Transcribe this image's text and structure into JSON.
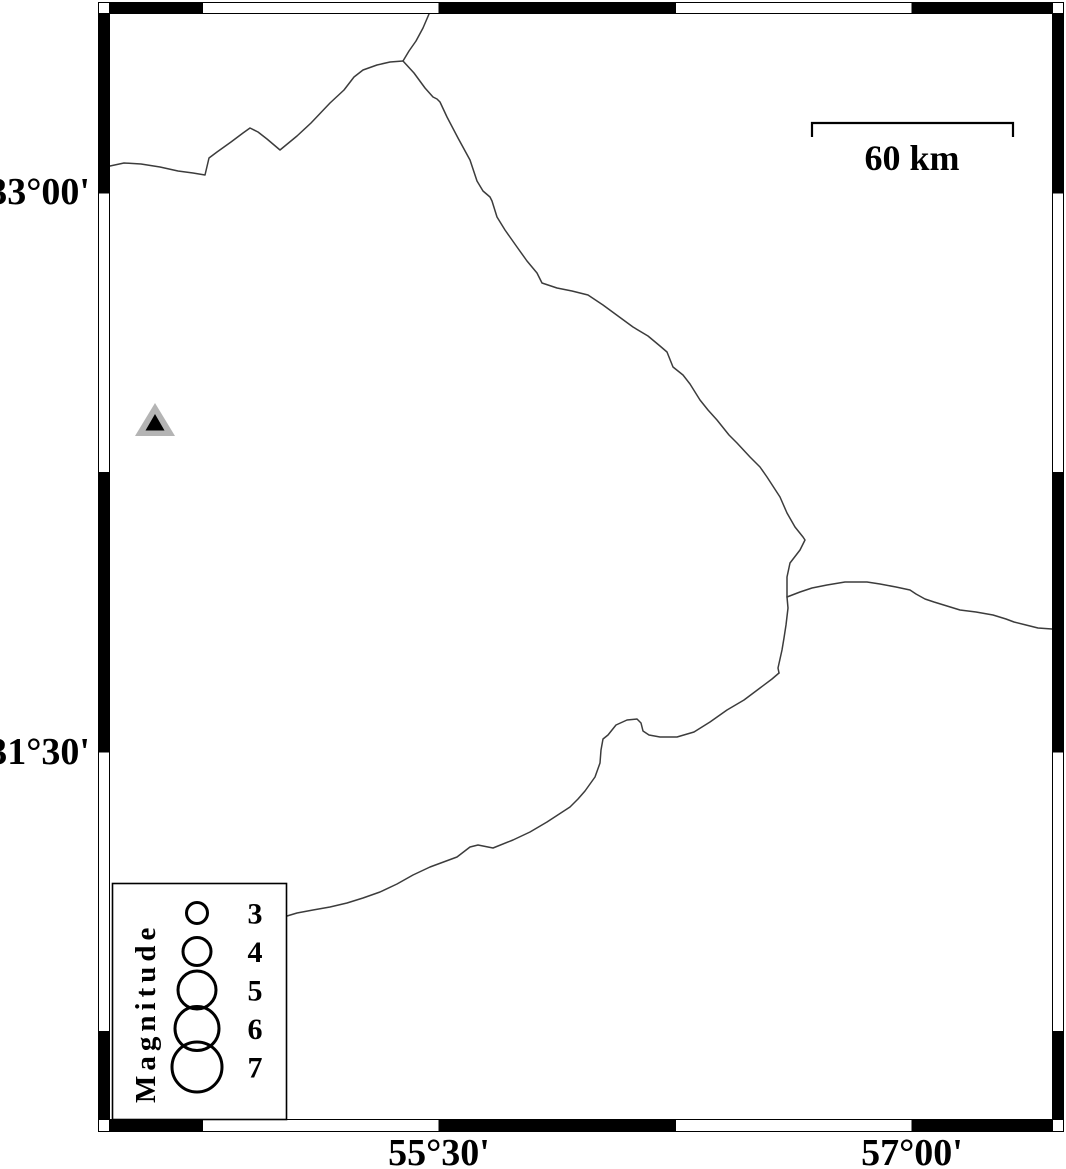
{
  "figure": {
    "type": "seismicity-map",
    "background": "#ffffff",
    "frame_color": "#000000",
    "road_color": "#3c3c3c",
    "width": 1066,
    "height": 1169
  },
  "frame": {
    "outer": {
      "x1": 98.5,
      "y1": 2.5,
      "x2": 1063.5,
      "y2": 1131.5
    },
    "inner": {
      "x1": 109.5,
      "y1": 13.5,
      "x2": 1052.5,
      "y2": 1119.5
    },
    "x_bounds": [
      110,
      202.5,
      439,
      675.5,
      912,
      1052.5
    ],
    "y_bounds": [
      13.5,
      193,
      472.5,
      752,
      1031.5,
      1119.5
    ]
  },
  "axes": {
    "lat_ticks": [
      {
        "label": "33°00'",
        "y": 192
      },
      {
        "label": "31°30'",
        "y": 752
      }
    ],
    "lon_ticks": [
      {
        "label": "55°30'",
        "x": 439
      },
      {
        "label": "57°00'",
        "x": 912
      }
    ]
  },
  "scale_bar": {
    "label": "60 km",
    "x1": 812,
    "x2": 1013,
    "y": 123,
    "tick_len": 14,
    "label_x": 912,
    "label_y": 170
  },
  "station_marker": {
    "shape": "triangle",
    "outer_points": "135,436 175,436 155,403",
    "inner_points": "145.5,430.5 164.5,430.5 155,414",
    "outer_color": "#b4b4b4",
    "inner_color": "#000000"
  },
  "legend": {
    "title": "Magnitude",
    "box": {
      "x": 112.5,
      "y": 883.5,
      "w": 174,
      "h": 236
    },
    "circle_x": 197,
    "number_x": 255,
    "title_x": 155,
    "title_y": 1103,
    "items": [
      {
        "magnitude": "3",
        "radius": 10.5,
        "row_y": 913
      },
      {
        "magnitude": "4",
        "radius": 14,
        "row_y": 951.5
      },
      {
        "magnitude": "5",
        "radius": 19,
        "row_y": 990
      },
      {
        "magnitude": "6",
        "radius": 22,
        "row_y": 1028.5
      },
      {
        "magnitude": "7",
        "radius": 25,
        "row_y": 1067
      }
    ]
  },
  "roads": [
    {
      "name": "west-road",
      "points": [
        [
          110,
          166
        ],
        [
          124,
          163
        ],
        [
          141,
          164
        ],
        [
          160,
          167
        ],
        [
          178,
          171
        ],
        [
          193,
          173
        ],
        [
          205,
          175
        ],
        [
          209,
          158
        ],
        [
          217,
          152
        ],
        [
          231,
          142
        ],
        [
          243,
          133
        ],
        [
          250,
          128
        ],
        [
          258,
          132
        ],
        [
          267,
          139
        ],
        [
          280,
          150
        ],
        [
          297,
          136
        ],
        [
          311,
          123
        ],
        [
          330,
          103
        ],
        [
          344,
          90
        ],
        [
          354,
          77
        ],
        [
          363,
          70
        ],
        [
          377,
          65
        ],
        [
          390,
          62
        ],
        [
          403,
          61
        ]
      ]
    },
    {
      "name": "north-branch",
      "points": [
        [
          403,
          61
        ],
        [
          409,
          51
        ],
        [
          416,
          41
        ],
        [
          423,
          28
        ],
        [
          429,
          14
        ]
      ]
    },
    {
      "name": "main-boundary",
      "points": [
        [
          403,
          61
        ],
        [
          414,
          73
        ],
        [
          425,
          88
        ],
        [
          433,
          97
        ],
        [
          437,
          99
        ],
        [
          440,
          102
        ],
        [
          447,
          117
        ],
        [
          458,
          138
        ],
        [
          470,
          160
        ],
        [
          477,
          181
        ],
        [
          483,
          191
        ],
        [
          490,
          197
        ],
        [
          492,
          201
        ],
        [
          497,
          217
        ],
        [
          505,
          230
        ],
        [
          517,
          247
        ],
        [
          527,
          261
        ],
        [
          537,
          273
        ],
        [
          542,
          283
        ],
        [
          557,
          288
        ],
        [
          572,
          291
        ],
        [
          588,
          295
        ],
        [
          603,
          305
        ],
        [
          618,
          316
        ],
        [
          633,
          327
        ],
        [
          648,
          336
        ],
        [
          660,
          346
        ],
        [
          667,
          352
        ],
        [
          673,
          367
        ],
        [
          683,
          375
        ],
        [
          690,
          384
        ],
        [
          700,
          400
        ],
        [
          708,
          410
        ],
        [
          717,
          420
        ],
        [
          729,
          435
        ],
        [
          737,
          443
        ],
        [
          750,
          457
        ],
        [
          760,
          467
        ],
        [
          767,
          477
        ],
        [
          780,
          497
        ],
        [
          787,
          513
        ],
        [
          795,
          527
        ],
        [
          803,
          537
        ],
        [
          805,
          540
        ],
        [
          800,
          550
        ],
        [
          790,
          563
        ],
        [
          787,
          577
        ],
        [
          787,
          597
        ],
        [
          788,
          608
        ],
        [
          786,
          625
        ],
        [
          784,
          638
        ],
        [
          782,
          650
        ],
        [
          778,
          668
        ],
        [
          779,
          673
        ]
      ]
    },
    {
      "name": "east-road",
      "points": [
        [
          787,
          597
        ],
        [
          800,
          592
        ],
        [
          812,
          588
        ],
        [
          827,
          585
        ],
        [
          845,
          582
        ],
        [
          867,
          582
        ],
        [
          880,
          584
        ],
        [
          896,
          587
        ],
        [
          910,
          590
        ],
        [
          916,
          594
        ],
        [
          925,
          599
        ],
        [
          934,
          602
        ],
        [
          947,
          606
        ],
        [
          960,
          610
        ],
        [
          976,
          612
        ],
        [
          993,
          615
        ],
        [
          1006,
          619
        ],
        [
          1014,
          622
        ],
        [
          1026,
          625
        ],
        [
          1038,
          628
        ],
        [
          1052,
          629
        ]
      ]
    },
    {
      "name": "southwest-road",
      "points": [
        [
          779,
          673
        ],
        [
          772,
          679
        ],
        [
          760,
          688
        ],
        [
          744,
          700
        ],
        [
          727,
          710
        ],
        [
          710,
          722
        ],
        [
          694,
          732
        ],
        [
          677,
          737
        ],
        [
          660,
          737
        ],
        [
          649,
          735
        ],
        [
          643,
          731
        ],
        [
          641,
          723
        ],
        [
          637,
          719
        ],
        [
          627,
          720
        ],
        [
          616,
          725
        ],
        [
          608,
          735
        ],
        [
          603,
          739
        ],
        [
          601,
          750
        ],
        [
          600,
          763
        ],
        [
          595,
          777
        ],
        [
          585,
          791
        ],
        [
          578,
          799
        ],
        [
          570,
          807
        ],
        [
          547,
          822
        ],
        [
          530,
          832
        ],
        [
          513,
          840
        ],
        [
          493,
          848
        ],
        [
          478,
          845
        ],
        [
          470,
          847
        ],
        [
          457,
          857
        ],
        [
          430,
          867
        ],
        [
          413,
          875
        ],
        [
          397,
          884
        ],
        [
          380,
          892
        ],
        [
          363,
          898
        ],
        [
          347,
          903
        ],
        [
          330,
          907
        ],
        [
          313,
          910
        ],
        [
          297,
          913
        ],
        [
          287,
          916
        ]
      ]
    }
  ]
}
